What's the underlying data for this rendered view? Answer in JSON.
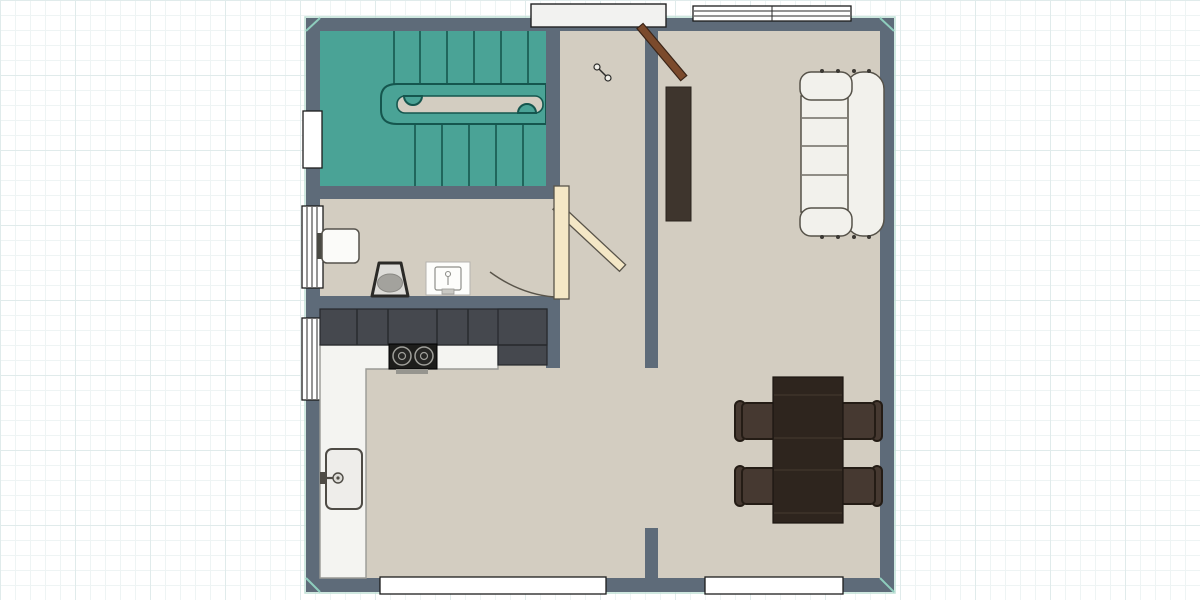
{
  "app": {
    "name": "floor-plan-canvas",
    "view": "2D top-down floor plan on grid paper"
  },
  "palette": {
    "wall": "#5e6b79",
    "floor": "#d3cdc1",
    "stairRoom": "#4aa396",
    "stairLine": "#15564e",
    "cabinet": "#45484e",
    "counter": "#f4f4f1",
    "counterLine": "#9a9a95",
    "cooktop": "#1d1d1b",
    "sofa": "#f2f1ec",
    "sofaLine": "#565249",
    "table": "#2e251e",
    "chair": "#463931",
    "chairLine": "#241c15",
    "console": "#3e352d",
    "doorLeaf": "#7b4a2c",
    "bathDoor": "#f4e7c6",
    "window": "#ffffff",
    "grid": "#eef4f4",
    "gridMajor": "#e0ebeb",
    "planEdge": "#bfe0d5"
  },
  "floor_plan": {
    "rooms": [
      {
        "id": "staircase-room",
        "floor": "teal"
      },
      {
        "id": "bathroom",
        "floor": "beige"
      },
      {
        "id": "kitchen",
        "floor": "beige"
      },
      {
        "id": "hallway",
        "floor": "beige"
      },
      {
        "id": "living-dining-room",
        "floor": "beige"
      }
    ],
    "doors": [
      {
        "id": "entry-door",
        "state": "open",
        "leaf_color": "brown",
        "location": "top wall at hallway"
      },
      {
        "id": "bathroom-door",
        "state": "open",
        "leaf_color": "cream",
        "location": "east wall of bathroom"
      }
    ],
    "windows": [
      {
        "id": "window-top-right",
        "location": "top wall, living room",
        "panes": 2
      },
      {
        "id": "window-left-staircase",
        "location": "left wall, staircase room",
        "panes": 1
      },
      {
        "id": "window-left-bathroom",
        "location": "left wall, bathroom",
        "panes": 3
      },
      {
        "id": "window-left-kitchen",
        "location": "left wall, kitchen",
        "panes": 3
      },
      {
        "id": "window-bottom-kitchen",
        "location": "bottom wall, kitchen side",
        "panes": 1
      },
      {
        "id": "window-bottom-living",
        "location": "bottom wall, living room",
        "panes": 1
      }
    ],
    "furniture": [
      {
        "id": "staircase",
        "type": "U-shaped stairs with central handrail",
        "room": "staircase-room"
      },
      {
        "id": "wall-basin",
        "room": "bathroom"
      },
      {
        "id": "toilet",
        "room": "bathroom"
      },
      {
        "id": "vanity-sink",
        "room": "bathroom"
      },
      {
        "id": "kitchen-cabinets",
        "type": "run of 6 base units",
        "room": "kitchen"
      },
      {
        "id": "tall-cabinet",
        "room": "kitchen"
      },
      {
        "id": "cooktop",
        "type": "2-burner hob",
        "room": "kitchen"
      },
      {
        "id": "kitchen-counter",
        "type": "L-shaped worktop",
        "room": "kitchen"
      },
      {
        "id": "kitchen-sink",
        "room": "kitchen"
      },
      {
        "id": "console-shelf",
        "room": "living-dining-room"
      },
      {
        "id": "sofa",
        "type": "3-seat sofa against east wall",
        "room": "living-dining-room"
      },
      {
        "id": "dining-table",
        "room": "living-dining-room"
      },
      {
        "id": "dining-chair",
        "count": 4,
        "room": "living-dining-room"
      }
    ]
  }
}
